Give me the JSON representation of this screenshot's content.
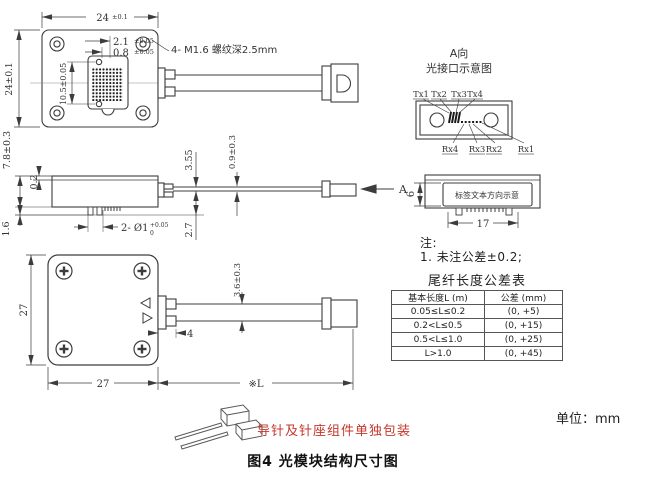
{
  "figure": {
    "caption": "图4 光模块结构尺寸图",
    "unit_note": "单位：mm",
    "packaging_note": "导针及针座组件单独包装"
  },
  "top_view": {
    "screw_note": "4- M1.6 螺纹深2.5mm",
    "dims": {
      "width": "24",
      "width_tol": "±0.1",
      "height": "24±0.1",
      "pitch_a": "2.1",
      "pitch_a_tol": "±0.05",
      "pitch_b": "0.8",
      "pitch_b_tol": "±0.05",
      "hole_span": "10.5±0.05"
    }
  },
  "side_view": {
    "arrow_label": "A",
    "dims": {
      "total_height": "7.8±0.3",
      "lid_thickness": "0.2",
      "pin_length": "1.6",
      "boot_height": "3.55",
      "pin_bottom": "2.7",
      "fiber_thickness": "0.9±0.3",
      "pin_callout": "2- Ø1",
      "pin_tol_upper": "+0.05",
      "pin_tol_lower": "0"
    }
  },
  "bottom_view": {
    "dims": {
      "width": "27",
      "height": "27",
      "stub": "4",
      "ribbon_width": "3.6±0.3",
      "pigtail_length": "※L"
    }
  },
  "optical_interface": {
    "title1": "A向",
    "title2": "光接口示意图",
    "tx_labels": [
      "Tx1",
      "Tx2",
      "Tx3",
      "Tx4"
    ],
    "rx_labels": [
      "Rx4",
      "Rx3",
      "Rx2",
      "Rx1"
    ]
  },
  "label_view": {
    "label_text": "标签文本方向示意",
    "dims": {
      "height": "6",
      "width": "17"
    }
  },
  "notes": {
    "head": "注:",
    "item1": "1. 未注公差±0.2;"
  },
  "tolerance_table": {
    "title": "尾纤长度公差表",
    "headers": [
      "基本长度L (m)",
      "公差 (mm)"
    ],
    "rows": [
      [
        "0.05≤L≤0.2",
        "(0, +5)"
      ],
      [
        "0.2<L≤0.5",
        "(0, +15)"
      ],
      [
        "0.5<L≤1.0",
        "(0, +25)"
      ],
      [
        "L>1.0",
        "(0, +45)"
      ]
    ]
  },
  "colors": {
    "line": "#3c3c3c",
    "red_note": "#c4382b"
  }
}
